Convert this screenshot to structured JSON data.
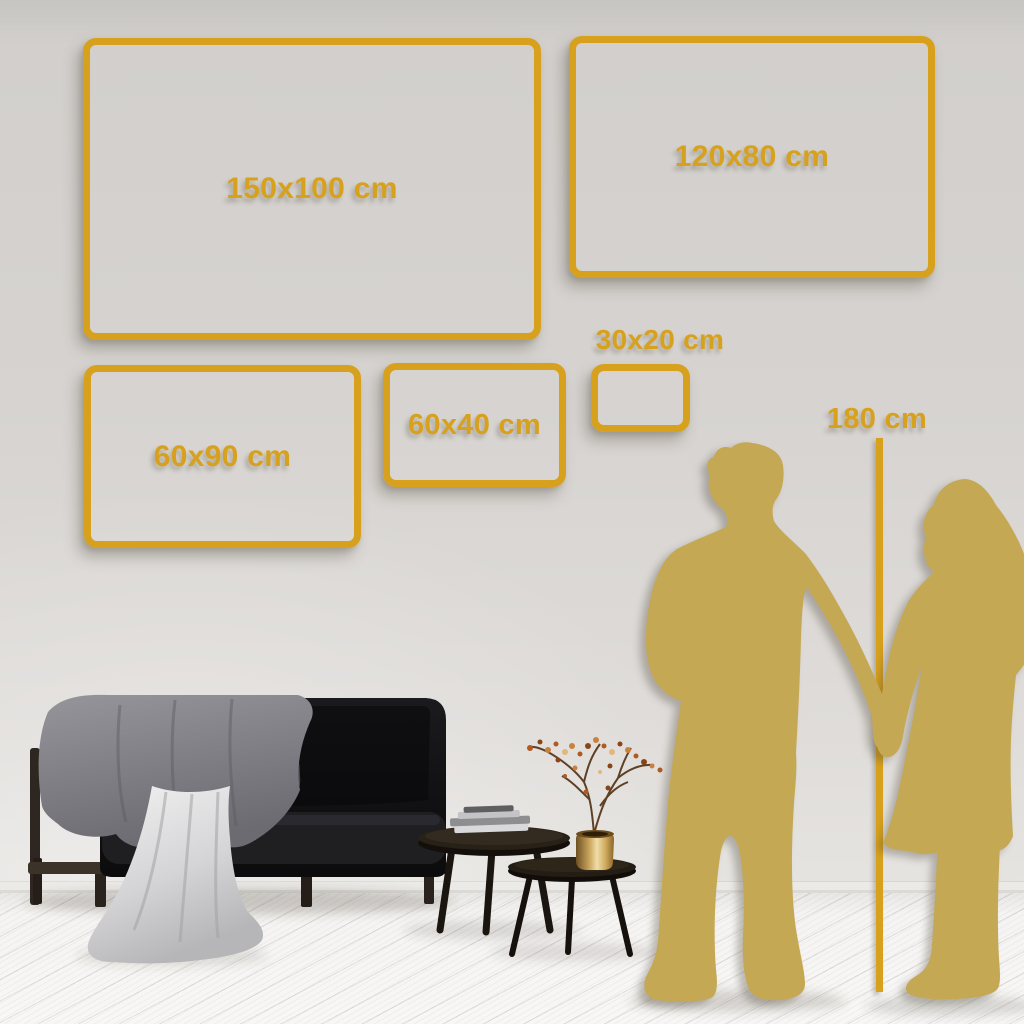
{
  "size_frames": [
    {
      "id": "150x100",
      "label": "150x100 cm"
    },
    {
      "id": "120x80",
      "label": "120x80 cm"
    },
    {
      "id": "60x90",
      "label": "60x90 cm"
    },
    {
      "id": "60x40",
      "label": "60x40 cm"
    },
    {
      "id": "30x20",
      "label": "30x20 cm"
    }
  ],
  "height_marker": {
    "label": "180 cm"
  },
  "colors": {
    "frame_gold": "#D7A11D",
    "silhouette_gold": "#C5A854",
    "wall_gray": "#D6D3D0",
    "floor_white": "#F6F5F3"
  },
  "scene": {
    "objects": [
      "sofa",
      "throw-blanket",
      "draped-cloth",
      "gray-cushion",
      "beige-cushion",
      "coffee-table-large",
      "coffee-table-small",
      "books-stack",
      "brass-vase",
      "dried-plant",
      "man-silhouette",
      "woman-silhouette",
      "height-reference-line"
    ]
  }
}
